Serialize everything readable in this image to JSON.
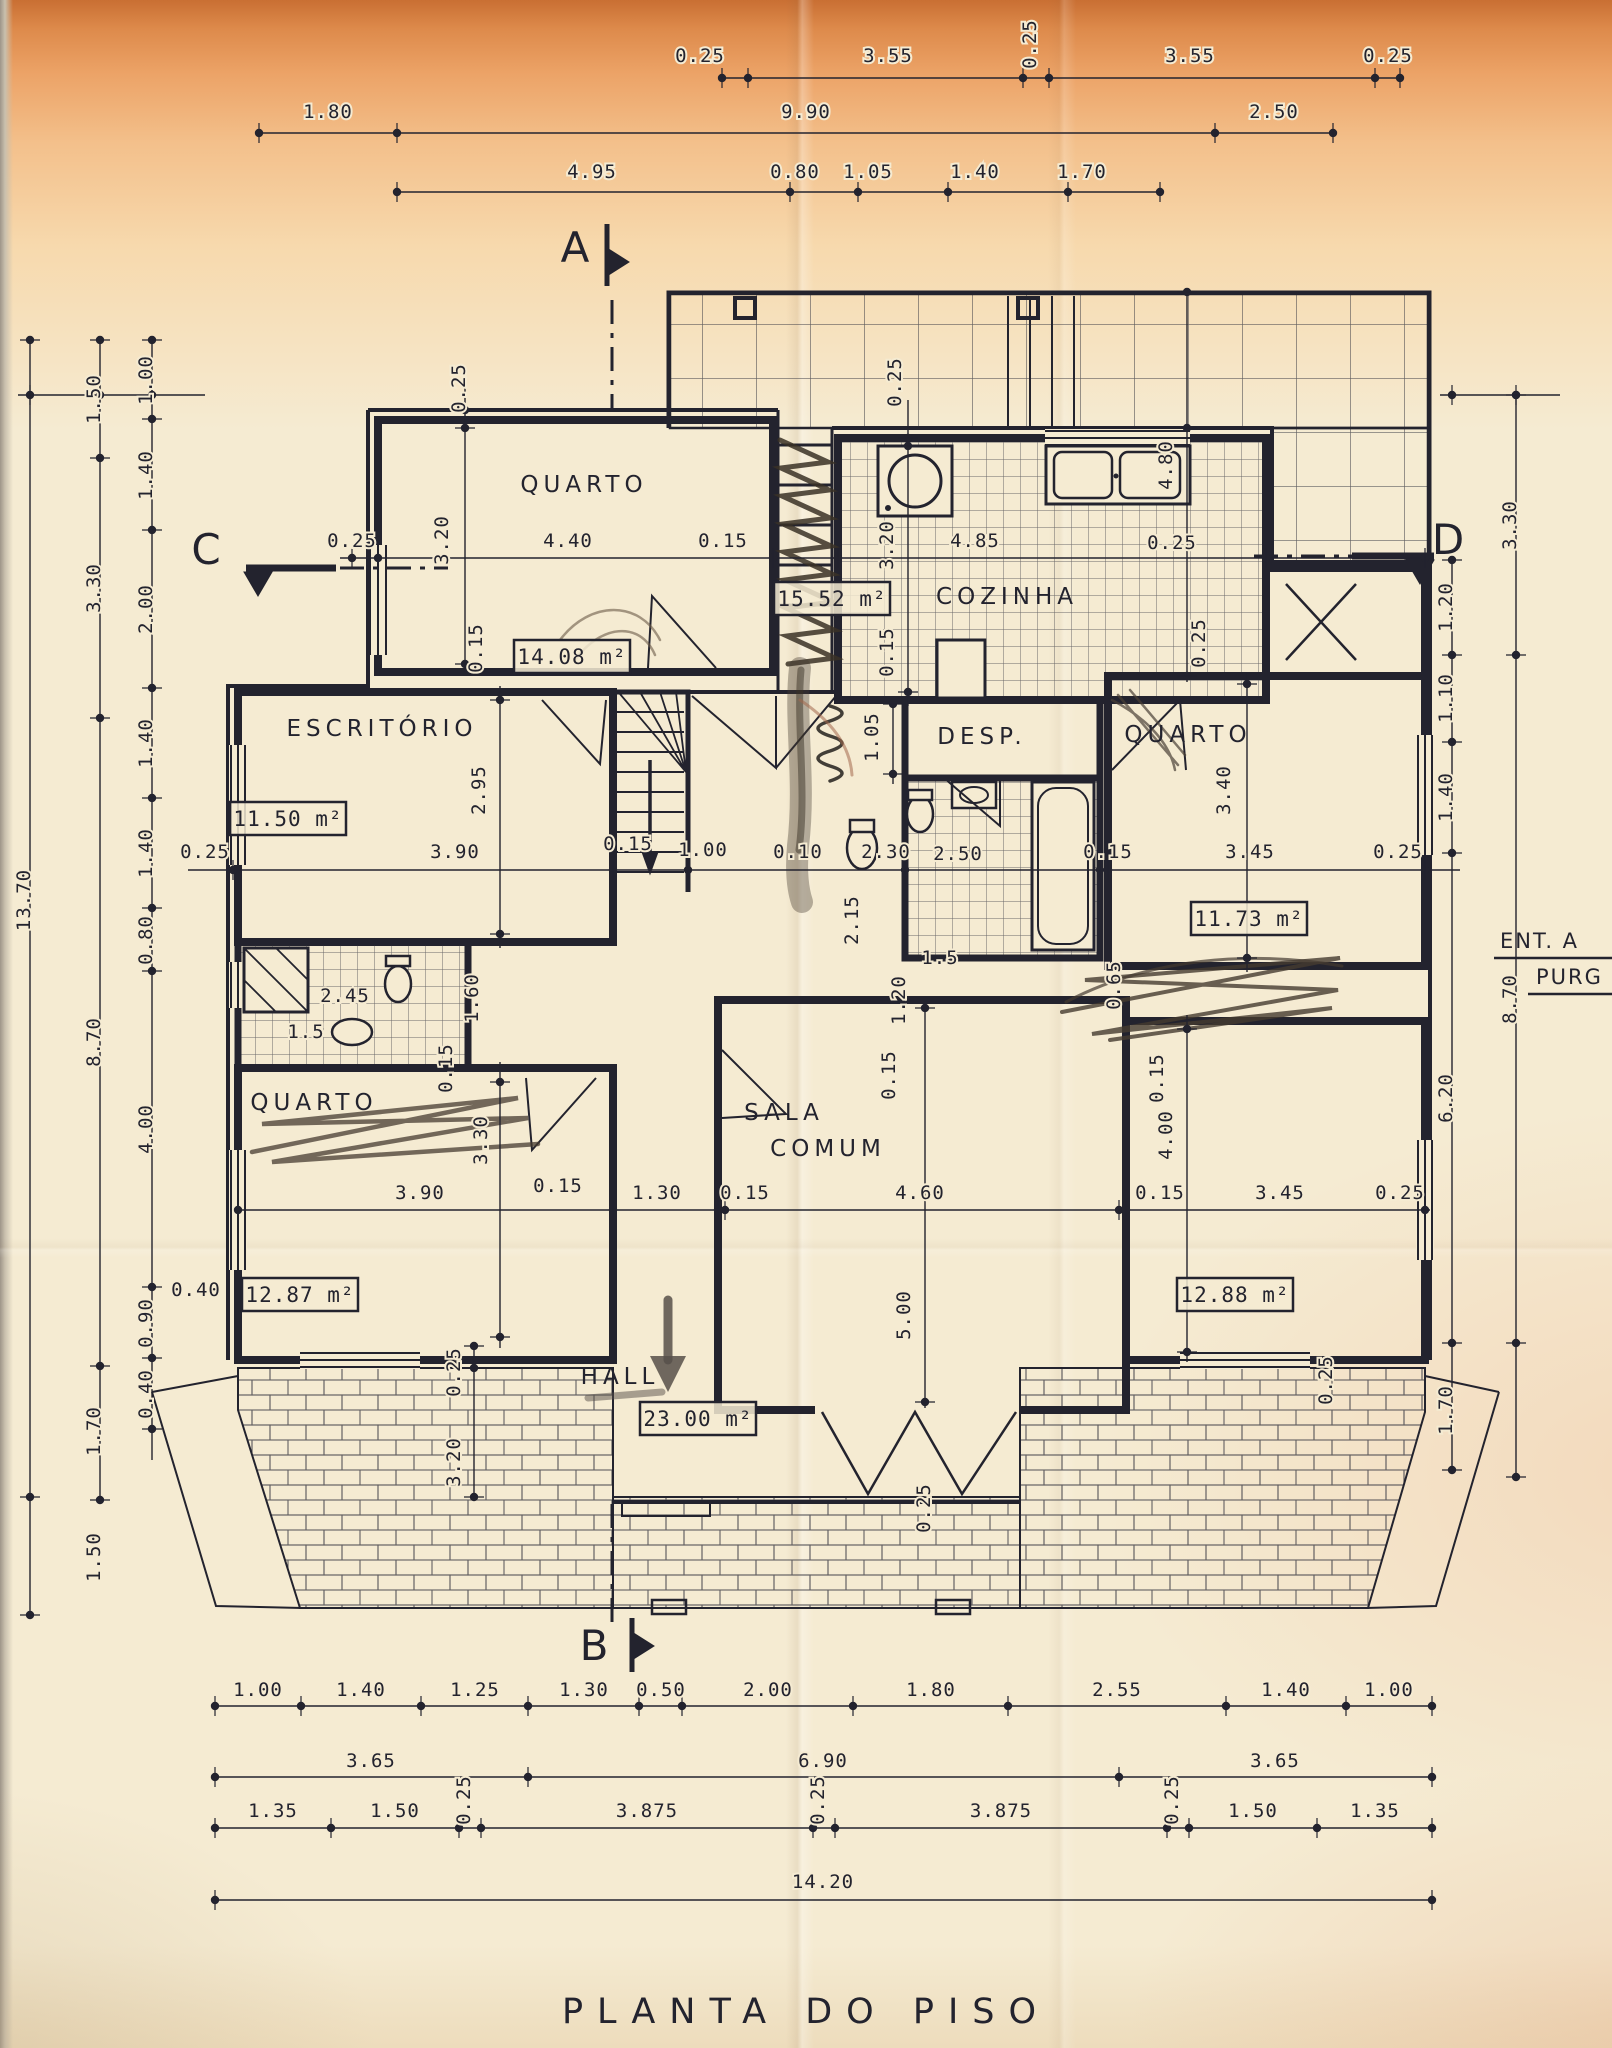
{
  "title": "PLANTA DO PISO",
  "colors": {
    "ink": "#23232e",
    "paper": "#f5ebd2",
    "pencil": "#473d33",
    "sienna": "#a2674d",
    "top_band": "#dd8a4b"
  },
  "notes": [
    {
      "t": "ENT. A",
      "x": 1500,
      "y": 948
    },
    {
      "t": "PURG",
      "x": 1536,
      "y": 984
    }
  ],
  "markers": [
    {
      "t": "A",
      "x": 575,
      "y": 262
    },
    {
      "t": "B",
      "x": 594,
      "y": 1660
    },
    {
      "t": "C",
      "x": 206,
      "y": 564
    },
    {
      "t": "D",
      "x": 1448,
      "y": 554
    }
  ],
  "rooms": [
    {
      "t": "QUARTO",
      "x": 584,
      "y": 492
    },
    {
      "t": "COZINHA",
      "x": 1007,
      "y": 604
    },
    {
      "t": "ESCRITÓRIO",
      "x": 382,
      "y": 736
    },
    {
      "t": "DESP.",
      "x": 982,
      "y": 744
    },
    {
      "t": "QUARTO",
      "x": 1188,
      "y": 742
    },
    {
      "t": "QUARTO",
      "x": 314,
      "y": 1110
    },
    {
      "t": "SALA",
      "x": 784,
      "y": 1120
    },
    {
      "t": "COMUM",
      "x": 828,
      "y": 1156
    },
    {
      "t": "HALL",
      "x": 620,
      "y": 1384
    }
  ],
  "areas": [
    {
      "t": "14.08 m²",
      "x": 572,
      "y": 664
    },
    {
      "t": "15.52 m²",
      "x": 832,
      "y": 606
    },
    {
      "t": "11.50 m²",
      "x": 288,
      "y": 826
    },
    {
      "t": "11.73 m²",
      "x": 1249,
      "y": 926
    },
    {
      "t": "12.87 m²",
      "x": 300,
      "y": 1302
    },
    {
      "t": "12.88 m²",
      "x": 1235,
      "y": 1302
    },
    {
      "t": "23.00 m²",
      "x": 698,
      "y": 1426
    }
  ],
  "dims": [
    {
      "t": "0.25",
      "x": 700,
      "y": 62
    },
    {
      "t": "3.55",
      "x": 888,
      "y": 62
    },
    {
      "t": "3.55",
      "x": 1190,
      "y": 62
    },
    {
      "t": "0.25",
      "x": 1388,
      "y": 62
    },
    {
      "t": "1.80",
      "x": 328,
      "y": 118
    },
    {
      "t": "9.90",
      "x": 806,
      "y": 118
    },
    {
      "t": "2.50",
      "x": 1274,
      "y": 118
    },
    {
      "t": "4.95",
      "x": 592,
      "y": 178
    },
    {
      "t": "0.80",
      "x": 795,
      "y": 178
    },
    {
      "t": "1.05",
      "x": 868,
      "y": 178
    },
    {
      "t": "1.40",
      "x": 975,
      "y": 178
    },
    {
      "t": "1.70",
      "x": 1082,
      "y": 178
    },
    {
      "t": "0.25",
      "x": 352,
      "y": 547
    },
    {
      "t": "4.40",
      "x": 568,
      "y": 547
    },
    {
      "t": "0.15",
      "x": 723,
      "y": 547
    },
    {
      "t": "4.85",
      "x": 975,
      "y": 547
    },
    {
      "t": "0.25",
      "x": 1172,
      "y": 549
    },
    {
      "t": "0.25",
      "x": 205,
      "y": 858
    },
    {
      "t": "3.90",
      "x": 455,
      "y": 858
    },
    {
      "t": "0.15",
      "x": 628,
      "y": 850
    },
    {
      "t": "1.00",
      "x": 703,
      "y": 856
    },
    {
      "t": "0.10",
      "x": 798,
      "y": 858
    },
    {
      "t": "2.30",
      "x": 886,
      "y": 858
    },
    {
      "t": "2.50",
      "x": 958,
      "y": 860
    },
    {
      "t": "0.15",
      "x": 1108,
      "y": 858
    },
    {
      "t": "3.45",
      "x": 1250,
      "y": 858
    },
    {
      "t": "0.25",
      "x": 1398,
      "y": 858
    },
    {
      "t": "1.5",
      "x": 940,
      "y": 964
    },
    {
      "t": "2.45",
      "x": 345,
      "y": 1002
    },
    {
      "t": "1.5",
      "x": 306,
      "y": 1038
    },
    {
      "t": "3.90",
      "x": 420,
      "y": 1199
    },
    {
      "t": "0.15",
      "x": 558,
      "y": 1192
    },
    {
      "t": "1.30",
      "x": 657,
      "y": 1199
    },
    {
      "t": "0.15",
      "x": 745,
      "y": 1199
    },
    {
      "t": "4.60",
      "x": 920,
      "y": 1199
    },
    {
      "t": "0.15",
      "x": 1160,
      "y": 1199
    },
    {
      "t": "3.45",
      "x": 1280,
      "y": 1199
    },
    {
      "t": "0.25",
      "x": 1400,
      "y": 1199
    },
    {
      "t": "1.00",
      "x": 258,
      "y": 1696
    },
    {
      "t": "1.40",
      "x": 361,
      "y": 1696
    },
    {
      "t": "1.25",
      "x": 475,
      "y": 1696
    },
    {
      "t": "1.30",
      "x": 584,
      "y": 1696
    },
    {
      "t": "0.50",
      "x": 661,
      "y": 1696
    },
    {
      "t": "2.00",
      "x": 768,
      "y": 1696
    },
    {
      "t": "1.80",
      "x": 931,
      "y": 1696
    },
    {
      "t": "2.55",
      "x": 1117,
      "y": 1696
    },
    {
      "t": "1.40",
      "x": 1286,
      "y": 1696
    },
    {
      "t": "1.00",
      "x": 1389,
      "y": 1696
    },
    {
      "t": "3.65",
      "x": 371,
      "y": 1767
    },
    {
      "t": "6.90",
      "x": 823,
      "y": 1767
    },
    {
      "t": "3.65",
      "x": 1275,
      "y": 1767
    },
    {
      "t": "1.35",
      "x": 273,
      "y": 1817
    },
    {
      "t": "1.50",
      "x": 395,
      "y": 1817
    },
    {
      "t": "3.875",
      "x": 647,
      "y": 1817
    },
    {
      "t": "3.875",
      "x": 1001,
      "y": 1817
    },
    {
      "t": "1.50",
      "x": 1253,
      "y": 1817
    },
    {
      "t": "1.35",
      "x": 1375,
      "y": 1817
    },
    {
      "t": "14.20",
      "x": 823,
      "y": 1888
    },
    {
      "t": "0.40",
      "x": 196,
      "y": 1296
    }
  ],
  "dims_rot": [
    {
      "t": "0.25",
      "x": 1036,
      "y": 44
    },
    {
      "t": "1.50",
      "x": 100,
      "y": 399
    },
    {
      "t": "3.30",
      "x": 100,
      "y": 588
    },
    {
      "t": "8.70",
      "x": 100,
      "y": 1042
    },
    {
      "t": "1.70",
      "x": 100,
      "y": 1431
    },
    {
      "t": "1.50",
      "x": 100,
      "y": 1557
    },
    {
      "t": "13.70",
      "x": 30,
      "y": 900
    },
    {
      "t": "1.00",
      "x": 152,
      "y": 380
    },
    {
      "t": "1.40",
      "x": 152,
      "y": 475
    },
    {
      "t": "2.00",
      "x": 152,
      "y": 609
    },
    {
      "t": "1.40",
      "x": 152,
      "y": 743
    },
    {
      "t": "1.40",
      "x": 152,
      "y": 853
    },
    {
      "t": "0.80",
      "x": 152,
      "y": 940
    },
    {
      "t": "4.00",
      "x": 152,
      "y": 1129
    },
    {
      "t": "0.90",
      "x": 152,
      "y": 1323
    },
    {
      "t": "0.40",
      "x": 152,
      "y": 1394
    },
    {
      "t": "1.20",
      "x": 1452,
      "y": 607
    },
    {
      "t": "1.10",
      "x": 1452,
      "y": 698
    },
    {
      "t": "1.40",
      "x": 1452,
      "y": 797
    },
    {
      "t": "6.20",
      "x": 1452,
      "y": 1098
    },
    {
      "t": "1.70",
      "x": 1452,
      "y": 1410
    },
    {
      "t": "3.30",
      "x": 1516,
      "y": 525
    },
    {
      "t": "8.70",
      "x": 1516,
      "y": 999
    },
    {
      "t": "0.25",
      "x": 465,
      "y": 388
    },
    {
      "t": "3.20",
      "x": 448,
      "y": 540
    },
    {
      "t": "0.25",
      "x": 901,
      "y": 382
    },
    {
      "t": "3.20",
      "x": 893,
      "y": 545
    },
    {
      "t": "0.15",
      "x": 893,
      "y": 652
    },
    {
      "t": "4.80",
      "x": 1172,
      "y": 465
    },
    {
      "t": "0.25",
      "x": 1205,
      "y": 643
    },
    {
      "t": "0.15",
      "x": 482,
      "y": 648
    },
    {
      "t": "2.95",
      "x": 485,
      "y": 790
    },
    {
      "t": "3.40",
      "x": 1230,
      "y": 790
    },
    {
      "t": "1.05",
      "x": 878,
      "y": 737
    },
    {
      "t": "2.15",
      "x": 858,
      "y": 920
    },
    {
      "t": "1.60",
      "x": 478,
      "y": 998
    },
    {
      "t": "1.20",
      "x": 905,
      "y": 1000
    },
    {
      "t": "0.65",
      "x": 1120,
      "y": 985
    },
    {
      "t": "0.15",
      "x": 895,
      "y": 1075
    },
    {
      "t": "0.15",
      "x": 1163,
      "y": 1078
    },
    {
      "t": "0.15",
      "x": 452,
      "y": 1068
    },
    {
      "t": "3.30",
      "x": 487,
      "y": 1140
    },
    {
      "t": "4.00",
      "x": 1172,
      "y": 1135
    },
    {
      "t": "5.00",
      "x": 910,
      "y": 1315
    },
    {
      "t": "0.25",
      "x": 460,
      "y": 1372
    },
    {
      "t": "3.20",
      "x": 460,
      "y": 1462
    },
    {
      "t": "0.25",
      "x": 1332,
      "y": 1380
    },
    {
      "t": "0.25",
      "x": 930,
      "y": 1508
    },
    {
      "t": "0.25",
      "x": 470,
      "y": 1800
    },
    {
      "t": "0.25",
      "x": 824,
      "y": 1800
    },
    {
      "t": "0.25",
      "x": 1178,
      "y": 1800
    }
  ],
  "chains": [
    {
      "o": "h",
      "c": 78,
      "a": 722,
      "b": 1400,
      "d": [
        722,
        748,
        1023,
        1049,
        1375,
        1400
      ]
    },
    {
      "o": "h",
      "c": 133,
      "a": 259,
      "b": 1333,
      "d": [
        259,
        397,
        1215,
        1333
      ]
    },
    {
      "o": "h",
      "c": 192,
      "a": 397,
      "b": 1160,
      "d": [
        397,
        790,
        858,
        948,
        1068,
        1160
      ]
    },
    {
      "o": "h",
      "c": 558,
      "a": 340,
      "b": 1425,
      "d": [
        352,
        378,
        773,
        838,
        1266,
        1425
      ]
    },
    {
      "o": "h",
      "c": 870,
      "a": 188,
      "b": 1460,
      "d": [
        233,
        613,
        688,
        905,
        1100,
        1108,
        1425
      ]
    },
    {
      "o": "h",
      "c": 1210,
      "a": 238,
      "b": 1430,
      "d": [
        238,
        613,
        718,
        725,
        1119,
        1126,
        1425
      ]
    },
    {
      "o": "h",
      "c": 1706,
      "a": 215,
      "b": 1432,
      "d": [
        215,
        301,
        421,
        528,
        639,
        682,
        853,
        1008,
        1226,
        1346,
        1432
      ]
    },
    {
      "o": "h",
      "c": 1777,
      "a": 215,
      "b": 1432,
      "d": [
        215,
        528,
        1119,
        1432
      ]
    },
    {
      "o": "h",
      "c": 1828,
      "a": 215,
      "b": 1432,
      "d": [
        215,
        331,
        459,
        481,
        813,
        835,
        1167,
        1189,
        1317,
        1432
      ]
    },
    {
      "o": "h",
      "c": 1900,
      "a": 215,
      "b": 1432,
      "d": [
        215,
        1432
      ]
    },
    {
      "o": "h",
      "c": 395,
      "a": 18,
      "b": 205,
      "d": [
        30,
        100,
        152
      ]
    },
    {
      "o": "h",
      "c": 395,
      "a": 1440,
      "b": 1560,
      "d": [
        1452,
        1516
      ]
    },
    {
      "o": "v",
      "c": 30,
      "a": 340,
      "b": 1615,
      "d": [
        340,
        1497,
        1615
      ]
    },
    {
      "o": "v",
      "c": 100,
      "a": 340,
      "b": 1500,
      "d": [
        340,
        458,
        718,
        1366,
        1500
      ]
    },
    {
      "o": "v",
      "c": 152,
      "a": 340,
      "b": 1460,
      "d": [
        340,
        419,
        530,
        688,
        798,
        908,
        971,
        1287,
        1358,
        1429
      ]
    },
    {
      "o": "v",
      "c": 1452,
      "a": 560,
      "b": 1470,
      "d": [
        560,
        655,
        742,
        853,
        1343,
        1470
      ]
    },
    {
      "o": "v",
      "c": 1516,
      "a": 395,
      "b": 1477,
      "d": [
        395,
        655,
        1343,
        1477
      ]
    },
    {
      "o": "v",
      "c": 465,
      "a": 378,
      "b": 672,
      "d": [
        410,
        428,
        664
      ]
    },
    {
      "o": "v",
      "c": 908,
      "a": 400,
      "b": 706,
      "d": [
        438,
        446,
        692
      ]
    },
    {
      "o": "v",
      "c": 1187,
      "a": 292,
      "b": 682,
      "d": [
        292,
        428,
        676
      ]
    },
    {
      "o": "v",
      "c": 1247,
      "a": 672,
      "b": 972,
      "d": [
        684,
        958
      ]
    },
    {
      "o": "v",
      "c": 893,
      "a": 696,
      "b": 784,
      "d": [
        704,
        774
      ]
    },
    {
      "o": "v",
      "c": 500,
      "a": 686,
      "b": 948,
      "d": [
        700,
        934
      ]
    },
    {
      "o": "v",
      "c": 925,
      "a": 1002,
      "b": 1408,
      "d": [
        1008,
        1402
      ]
    },
    {
      "o": "v",
      "c": 1187,
      "a": 1015,
      "b": 1362,
      "d": [
        1029,
        1352
      ]
    },
    {
      "o": "v",
      "c": 500,
      "a": 1062,
      "b": 1348,
      "d": [
        1082,
        1337
      ]
    },
    {
      "o": "v",
      "c": 474,
      "a": 1346,
      "b": 1500,
      "d": [
        1346,
        1368,
        1497
      ]
    }
  ]
}
